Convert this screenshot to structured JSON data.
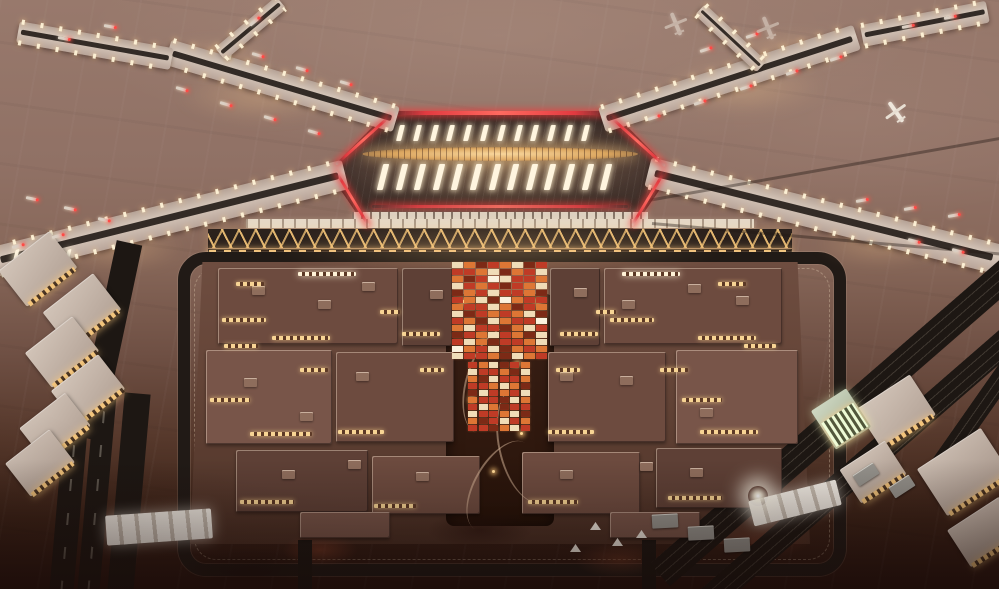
{
  "scene": {
    "description": "Aerial dusk photograph of an X-shaped airport terminal lit in gold with red neon roof edging, four gated piers over a vast mauve apron, a zigzag-lit forecourt canopy, and a large landside building complex under construction ringed by dark roads, rail corridors and expressways, with white tensile canopies and scattered construction sheds below."
  },
  "palette": {
    "apron": "#8e7064",
    "pier_dark": "#332b26",
    "gold": "#f2c47c",
    "amber": "#e8a658",
    "neon": "#e23a40",
    "beacon": "#ff4a46",
    "skylight": "#fff5df",
    "blk_a": "#6d4b3f",
    "blk_b": "#5e4036",
    "blk_c": "#785549",
    "window": "#f7d494",
    "road": "#1d1713",
    "mosaic_r": "#bf3b26",
    "mosaic_o": "#dd7635",
    "mosaic_c": "#f0ddb8",
    "mosaic_d": "#7c2a16",
    "mosaic_w": "#fbf3df"
  },
  "glows": [
    [
      262,
      96,
      170,
      54
    ],
    [
      742,
      88,
      170,
      54
    ],
    [
      120,
      248,
      130,
      44
    ],
    [
      880,
      244,
      130,
      44
    ],
    [
      500,
      248,
      460,
      56
    ],
    [
      500,
      166,
      300,
      90
    ],
    [
      215,
      58,
      120,
      36
    ],
    [
      790,
      50,
      120,
      36
    ],
    [
      500,
      300,
      200,
      70
    ]
  ],
  "piers": [
    {
      "x": 168,
      "y": 39,
      "w": 238,
      "h": 26,
      "rot": 16.5
    },
    {
      "x": 18,
      "y": 21,
      "w": 156,
      "h": 22,
      "rot": 10
    },
    {
      "x": 220,
      "y": 46,
      "w": 80,
      "h": 16,
      "rot": -40
    },
    {
      "x": 602,
      "y": 107,
      "w": 268,
      "h": 26,
      "rot": -18
    },
    {
      "x": 862,
      "y": 25,
      "w": 128,
      "h": 22,
      "rot": -11
    },
    {
      "x": 700,
      "y": 2,
      "w": 84,
      "h": 15,
      "rot": 43
    },
    {
      "x": -6,
      "y": 247,
      "w": 362,
      "h": 30,
      "rot": -14
    },
    {
      "x": 648,
      "y": 157,
      "w": 362,
      "h": 30,
      "rot": 14
    }
  ],
  "skylight_rows": [
    {
      "x": 398,
      "y": 125,
      "dx": 16.8,
      "count": 12,
      "w": 5,
      "h": 16,
      "skew": -14,
      "rot": 0
    },
    {
      "x": 380,
      "y": 164,
      "dx": 18.6,
      "count": 13,
      "w": 6,
      "h": 26,
      "skew": -14,
      "rot": 0
    },
    {
      "x": 14,
      "y": 250,
      "dx": 13,
      "count": 5,
      "w": 4,
      "h": 12,
      "skew": -28,
      "rot": -14
    }
  ],
  "neon_slopes": [
    [
      336,
      163,
      74,
      -42
    ],
    [
      610,
      115,
      74,
      42
    ],
    [
      336,
      170,
      63,
      59
    ],
    [
      632,
      224,
      63,
      -59
    ]
  ],
  "mosaic_segments": [
    {
      "x": 452,
      "y": 262,
      "cw": 12,
      "ch": 7,
      "rows": [
        "codrocdr",
        "rrocdorc",
        "odrwcrro",
        "crordroc",
        "dorcrrod",
        "rocdworr",
        "orrcodro",
        "cdrorocd",
        "rodcorrw",
        "ocrrdocr",
        "drocrodc",
        "rcodrroc",
        "worcdoro",
        "crrodcor"
      ]
    },
    {
      "x": 468,
      "y": 362,
      "cw": 10.6,
      "ch": 7,
      "rows": [
        "rocdro",
        "crrodc",
        "odcrro",
        "rrocod",
        "dcrorc",
        "orrdco",
        "rcodrr",
        "crrocd",
        "odrcro",
        "rrdocr"
      ]
    }
  ],
  "complex_blocks": [
    [
      218,
      268,
      180,
      76,
      "a"
    ],
    [
      402,
      268,
      50,
      78,
      "b"
    ],
    [
      550,
      268,
      50,
      78,
      "b"
    ],
    [
      604,
      268,
      178,
      76,
      "a"
    ],
    [
      206,
      350,
      126,
      94,
      "c"
    ],
    [
      336,
      352,
      118,
      90,
      "a"
    ],
    [
      548,
      352,
      118,
      90,
      "a"
    ],
    [
      676,
      350,
      122,
      94,
      "c"
    ],
    [
      236,
      450,
      132,
      62,
      "b"
    ],
    [
      372,
      456,
      108,
      58,
      "a"
    ],
    [
      522,
      452,
      118,
      62,
      "a"
    ],
    [
      656,
      448,
      126,
      60,
      "b"
    ],
    [
      300,
      512,
      90,
      26,
      "c"
    ],
    [
      610,
      512,
      90,
      26,
      "c"
    ]
  ],
  "rooftop_units": [
    [
      252,
      286
    ],
    [
      318,
      300
    ],
    [
      362,
      282
    ],
    [
      430,
      290
    ],
    [
      574,
      288
    ],
    [
      622,
      300
    ],
    [
      688,
      284
    ],
    [
      736,
      296
    ],
    [
      244,
      378
    ],
    [
      300,
      412
    ],
    [
      356,
      372
    ],
    [
      620,
      376
    ],
    [
      700,
      408
    ],
    [
      560,
      372
    ],
    [
      282,
      470
    ],
    [
      416,
      472
    ],
    [
      560,
      470
    ],
    [
      690,
      468
    ],
    [
      348,
      460
    ],
    [
      640,
      462
    ]
  ],
  "windows": [
    [
      222,
      318,
      44,
      "g"
    ],
    [
      272,
      336,
      58,
      "g"
    ],
    [
      224,
      344,
      34,
      "g"
    ],
    [
      610,
      318,
      44,
      "g"
    ],
    [
      698,
      336,
      58,
      "g"
    ],
    [
      744,
      344,
      32,
      "g"
    ],
    [
      210,
      398,
      40,
      "g"
    ],
    [
      250,
      432,
      62,
      "g"
    ],
    [
      338,
      430,
      46,
      "g"
    ],
    [
      548,
      430,
      46,
      "g"
    ],
    [
      682,
      398,
      40,
      "g"
    ],
    [
      700,
      430,
      58,
      "g"
    ],
    [
      240,
      500,
      54,
      "g"
    ],
    [
      374,
      504,
      42,
      "g"
    ],
    [
      528,
      500,
      50,
      "g"
    ],
    [
      668,
      496,
      54,
      "g"
    ],
    [
      300,
      368,
      28,
      "g"
    ],
    [
      420,
      368,
      24,
      "g"
    ],
    [
      556,
      368,
      24,
      "g"
    ],
    [
      660,
      368,
      28,
      "g"
    ],
    [
      402,
      332,
      38,
      "g"
    ],
    [
      560,
      332,
      38,
      "g"
    ],
    [
      236,
      282,
      28,
      "g"
    ],
    [
      718,
      282,
      28,
      "g"
    ],
    [
      298,
      272,
      58,
      "w"
    ],
    [
      622,
      272,
      58,
      "w"
    ],
    [
      380,
      310,
      20,
      "g"
    ],
    [
      596,
      310,
      20,
      "g"
    ]
  ],
  "arcs": [
    [
      466,
      326,
      54,
      110,
      18
    ],
    [
      498,
      384,
      60,
      120,
      -12
    ],
    [
      474,
      436,
      50,
      100,
      30
    ]
  ],
  "lamps": [
    [
      482,
      334
    ],
    [
      516,
      362
    ],
    [
      470,
      398
    ],
    [
      520,
      432
    ],
    [
      492,
      470
    ],
    [
      536,
      300
    ],
    [
      462,
      300
    ]
  ],
  "roads": [
    {
      "x": 96,
      "y": 238,
      "w": 26,
      "h": 200,
      "rot": 12,
      "rail": false
    },
    {
      "x": 58,
      "y": 392,
      "w": 24,
      "h": 200,
      "rot": 5,
      "rail": true
    },
    {
      "x": 86,
      "y": 392,
      "w": 22,
      "h": 200,
      "rot": 5,
      "rail": true
    },
    {
      "x": 116,
      "y": 392,
      "w": 26,
      "h": 200,
      "rot": 5,
      "rail": false
    },
    {
      "x": 298,
      "y": 540,
      "w": 14,
      "h": 50,
      "rot": 0,
      "rail": false
    },
    {
      "x": 642,
      "y": 540,
      "w": 14,
      "h": 50,
      "rot": 0,
      "rail": false
    }
  ],
  "expressways": [
    {
      "x": 660,
      "y": 560,
      "w": 470,
      "h": 30,
      "rot": -41
    },
    {
      "x": 706,
      "y": 589,
      "w": 470,
      "h": 26,
      "rot": -41
    },
    {
      "x": 930,
      "y": 470,
      "w": 280,
      "h": 20,
      "rot": -55
    }
  ],
  "service_lines": [
    [
      648,
      199,
      364,
      3,
      -10
    ],
    [
      652,
      222,
      360,
      3,
      5
    ]
  ],
  "outer_buildings": [
    [
      6,
      246,
      64,
      46,
      -38,
      0
    ],
    [
      50,
      288,
      64,
      46,
      -38,
      0
    ],
    [
      32,
      330,
      60,
      44,
      -38,
      0
    ],
    [
      58,
      368,
      60,
      44,
      -38,
      0
    ],
    [
      26,
      406,
      58,
      42,
      -38,
      0
    ],
    [
      12,
      442,
      56,
      42,
      -38,
      0
    ],
    [
      864,
      388,
      64,
      48,
      -33,
      0
    ],
    [
      926,
      444,
      76,
      56,
      -33,
      0
    ],
    [
      846,
      452,
      54,
      40,
      -33,
      0
    ],
    [
      954,
      510,
      62,
      44,
      -33,
      0
    ],
    [
      820,
      396,
      42,
      46,
      -33,
      1
    ]
  ],
  "sheds": [
    [
      652,
      514,
      26,
      14,
      -3
    ],
    [
      688,
      526,
      26,
      14,
      -3
    ],
    [
      724,
      538,
      26,
      14,
      -3
    ],
    [
      854,
      468,
      24,
      13,
      -33
    ],
    [
      890,
      480,
      24,
      13,
      -33
    ]
  ],
  "tents": [
    [
      590,
      522
    ],
    [
      612,
      538
    ],
    [
      570,
      544
    ],
    [
      636,
      530
    ]
  ],
  "tensile_canopies": [
    {
      "x": 106,
      "y": 512,
      "w": 106,
      "h": 30,
      "rot": -4
    },
    {
      "x": 750,
      "y": 490,
      "w": 90,
      "h": 26,
      "rot": -14
    }
  ],
  "floodlights": [
    [
      748,
      486
    ]
  ],
  "stands": [
    [
      176,
      86,
      16
    ],
    [
      220,
      101,
      16
    ],
    [
      264,
      115,
      16
    ],
    [
      308,
      129,
      16
    ],
    [
      252,
      52,
      16
    ],
    [
      296,
      66,
      16
    ],
    [
      340,
      80,
      16
    ],
    [
      58,
      36,
      10
    ],
    [
      104,
      24,
      10
    ],
    [
      250,
      24,
      -40
    ],
    [
      648,
      118,
      -18
    ],
    [
      694,
      103,
      -18
    ],
    [
      740,
      88,
      -18
    ],
    [
      786,
      73,
      -18
    ],
    [
      830,
      59,
      -18
    ],
    [
      700,
      50,
      -18
    ],
    [
      746,
      36,
      -18
    ],
    [
      902,
      26,
      -11
    ],
    [
      944,
      17,
      -11
    ],
    [
      26,
      196,
      12
    ],
    [
      64,
      206,
      12
    ],
    [
      98,
      217,
      12
    ],
    [
      856,
      200,
      -10
    ],
    [
      904,
      208,
      -10
    ],
    [
      948,
      215,
      -10
    ],
    [
      12,
      246,
      -14
    ],
    [
      52,
      236,
      -14
    ],
    [
      908,
      238,
      14
    ],
    [
      952,
      248,
      14
    ]
  ],
  "aircraft": [
    [
      884,
      100,
      -35,
      1
    ],
    [
      664,
      12,
      -22,
      0.55
    ],
    [
      756,
      16,
      -22,
      0.5
    ]
  ]
}
